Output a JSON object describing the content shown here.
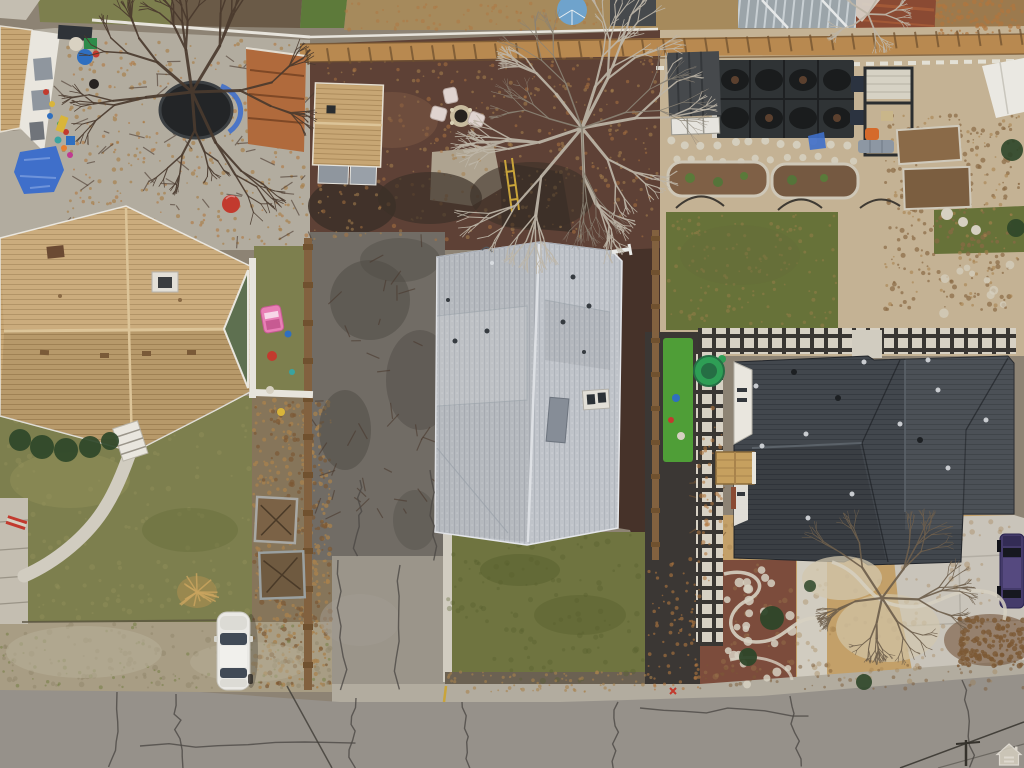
{
  "scene": {
    "type": "aerial-drone-photo",
    "description": "Top-down aerial drone view of a residential block: three homes with tan, light gray and dark charcoal roofs, backyards with fire pit, trampoline, pergola and garden beds, driveways, lawns and a cracked street along the bottom with a parked white car",
    "watermark": {
      "icon": "equal-housing-opportunity-logo"
    },
    "objects": [
      "left-house-tan-roof",
      "center-house-gray-roof",
      "right-house-dark-roof",
      "street",
      "white-car",
      "purple-suv",
      "fire-pit-with-chairs",
      "trampoline",
      "turtle-sandbox",
      "pergola-with-patio-furniture",
      "covered-garden-beds",
      "checkerboard-paver-path",
      "blue-tarp",
      "bare-winter-trees",
      "garden-boxes",
      "backyard-shed",
      "front-lawns",
      "curved-front-walkway",
      "wood-fences",
      "sidewalk"
    ],
    "palette": {
      "base": "#8d8374",
      "road": "#96918a",
      "roadCrack": "#4c4945",
      "curb": "#b2ac9f",
      "sidewalk": "#c4beb1",
      "walkPath": "#d1ccc0",
      "parkStrip": "#a89d84",
      "parkPatch": "#90856a",
      "parkLight": "#b6ad96",
      "lawnLeft": "#7d7f4e",
      "lawnLeftLight": "#94925c",
      "lawnLeftDark": "#636b39",
      "lawnCenter": "#6f7440",
      "lawnCenterDark": "#575f2e",
      "lawnRight": "#677239",
      "weedGreen": "#6f7c3e",
      "turf": "#4f9e37",
      "mulchRed": "#5e4136",
      "mulchLight": "#7d5a44",
      "mulchDark": "#463229",
      "soilDark": "#3c3028",
      "mulchFront": "#7c4c3c",
      "leafBase": "#86755a",
      "straw": "#c3a069",
      "strawDark": "#a07f4e",
      "gravel": "#c4b294",
      "gravelLight": "#d2c7ae",
      "gravelShade": "#6b6152",
      "topDirt": "#6a5a47",
      "dirtTan": "#a68a5c",
      "leafBed": "#9c7a4e",
      "padLight": "#b2a996",
      "asphaltDark": "#3b3734",
      "driveBase": "#716c65",
      "driveDark": "#4e4a44",
      "driveLight": "#a29c91",
      "concrete": "#c9c4ba",
      "paverLight": "#d7d1c4",
      "paverDark": "#393633",
      "wood": "#b88950",
      "woodDark": "#70512f",
      "woodFence": "#82613f",
      "whiteFence": "#e7e4dc",
      "whiteTrim": "#e9e6de",
      "roofTan": "#c7a674",
      "roofTanDark": "#ad8c5c",
      "roofTanRidge": "#dcc498",
      "roofGray": "#bfc3c9",
      "roofGrayDark": "#afb4bb",
      "roofGrayRidge": "#e2e5e9",
      "roofDark": "#42474d",
      "roofDarkRow": "#363b41",
      "roofDarkRidge": "#5b6269",
      "greenGable": "#5e7050",
      "chimneyStone": "#e2dfd7",
      "shedPanel": "#8f969e",
      "mesh": "#2f3335",
      "meshPod": "#1a1c1d",
      "pergolaTop": "#d6d2c4",
      "pergolaFrame": "#2b2e30",
      "canopy": "#eae8e2",
      "metalRoof": "#9ba4a9",
      "metalRoofLight": "#c8cfd3",
      "rustRoof": "#8a4a33",
      "rustLight": "#a25937",
      "tarpBlue": "#3f6fca",
      "tarpLight": "#6e93da",
      "umbrellaBlue": "#6fa3cc",
      "shedDarkGray": "#46494c",
      "sandGreen": "#2e9e55",
      "sandGreenDark": "#256e44",
      "carWhite": "#eae9e5",
      "carGlass": "#414a56",
      "jeepPurple": "#443b6a",
      "jeepDark": "#16181f",
      "pinkToy": "#e87fb5",
      "pinkToyDark": "#c75a92",
      "redToy": "#c23a2e",
      "yellowToy": "#d9b53a",
      "blueToy": "#2f6fc0",
      "tealToy": "#3aa3a0",
      "greenBin": "#2e8b4a",
      "treeDark": "#4a392e",
      "treeLight": "#bdb5a7",
      "treeMid": "#6e5e4c",
      "leafTan": "#a8824e",
      "leafOrange": "#b0763f",
      "leafBrown": "#7c5935",
      "deadPlant": "#8a6a44",
      "stone": "#d6d0c1",
      "bushGreen": "#2e4629",
      "firePitStone": "#c8bb9e",
      "firePitAsh": "#26221e",
      "chairPink": "#dfd3cf",
      "navyBox": "#2b3340",
      "orangeChair": "#d56a2b",
      "sofaGray": "#8d97a3",
      "grassTop": "#5d7a3a",
      "wmIcon": "#efeadf",
      "wmFill": "#d8d1c2"
    }
  }
}
